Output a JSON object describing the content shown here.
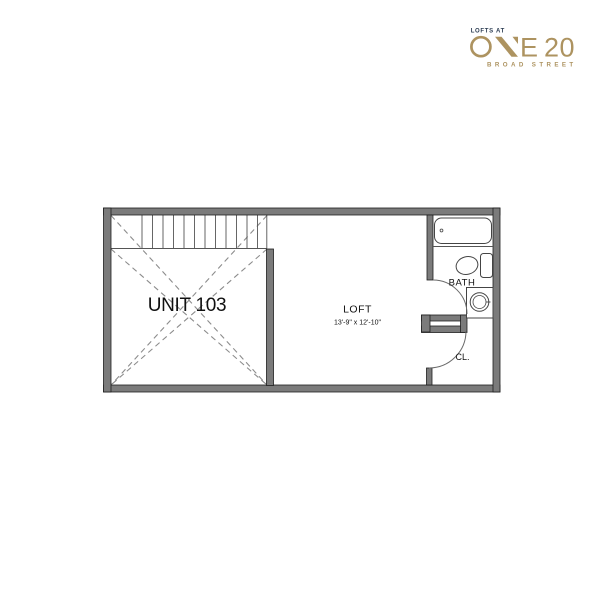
{
  "page": {
    "background": "#ffffff"
  },
  "logo": {
    "tagline": "LOFTS AT",
    "name": "ONE 20",
    "letter_e": "E",
    "number_20": "20",
    "street": "BROAD STREET",
    "colors": {
      "gold": "#ad9360",
      "navy": "#2b3c52"
    }
  },
  "floor_plan": {
    "unit_label": "UNIT 103",
    "rooms": [
      {
        "name": "LOFT",
        "dimensions": "13'-9\" x 12'-10\""
      },
      {
        "name": "BATH"
      },
      {
        "name": "CL."
      }
    ],
    "fixtures": [
      "stairs",
      "bathtub",
      "toilet",
      "sink-vanity",
      "bath-door",
      "closet-door"
    ],
    "colors": {
      "wall": "#7b7b7b",
      "thin_line": "#555555",
      "dashed_line": "#8c8c8c"
    }
  }
}
